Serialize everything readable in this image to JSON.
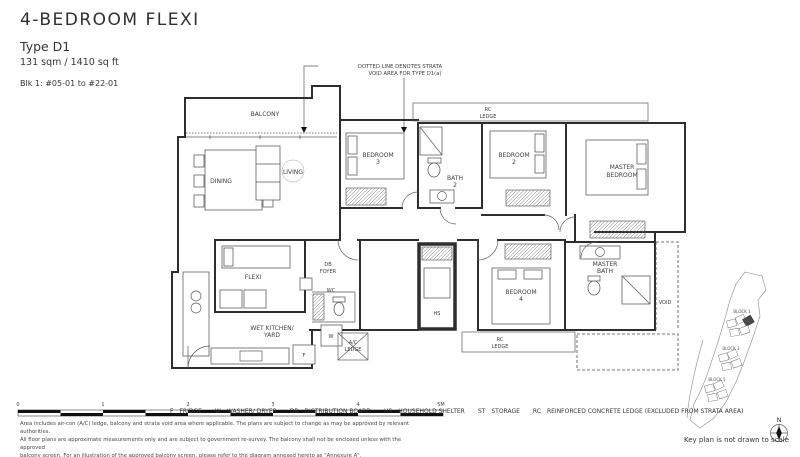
{
  "header": {
    "title": "4-BEDROOM FLEXI",
    "type": "Type D1",
    "area": "131 sqm / 1410 sq ft",
    "block_info": "Blk 1: #05-01 to #22-01"
  },
  "annotation": {
    "line1": "DOTTED LINE DENOTES STRATA",
    "line2": "VOID AREA FOR TYPE D1(a)"
  },
  "rooms": {
    "balcony": "BALCONY",
    "dining": "DINING",
    "living": "LIVING",
    "bedroom3_l1": "BEDROOM",
    "bedroom3_l2": "3",
    "bath2_l1": "BATH",
    "bath2_l2": "2",
    "bedroom2_l1": "BEDROOM",
    "bedroom2_l2": "2",
    "master_l1": "MASTER",
    "master_l2": "BEDROOM",
    "rc_ledge_top_l1": "RC",
    "rc_ledge_top_l2": "LEDGE",
    "flexi": "FLEXI",
    "foyer_l1": "DB",
    "foyer_l2": "FOYER",
    "wc": "WC",
    "hs": "HS",
    "washer": "W",
    "fridge": "F",
    "wet_kitchen_l1": "WET KITCHEN/",
    "wet_kitchen_l2": "YARD",
    "ac_ledge_l1": "A/C",
    "ac_ledge_l2": "LEDGE",
    "bedroom4_l1": "BEDROOM",
    "bedroom4_l2": "4",
    "rc_ledge_bottom_l1": "RC",
    "rc_ledge_bottom_l2": "LEDGE",
    "master_bath_l1": "MASTER",
    "master_bath_l2": "BATH",
    "void": "VOID"
  },
  "scale_bar": {
    "labels": [
      "0",
      "1",
      "2",
      "3",
      "4",
      "5M"
    ]
  },
  "legend": {
    "items": [
      {
        "abbr": "F",
        "label": "FRIDGE"
      },
      {
        "abbr": "W",
        "label": "WASHER/ DRYER"
      },
      {
        "abbr": "DB",
        "label": "DISTRIBUTION BOARD"
      },
      {
        "abbr": "HS",
        "label": "HOUSEHOLD SHELTER"
      },
      {
        "abbr": "ST",
        "label": "STORAGE"
      },
      {
        "abbr": "RC",
        "label": "REINFORCED CONCRETE LEDGE (EXCLUDED FROM STRATA AREA)"
      }
    ]
  },
  "disclaimer": {
    "line1": "Area includes air-con (A/C) ledge, balcony and strata void area where applicable. The plans are subject to change as may be approved by relevant authorities.",
    "line2": "All floor plans are approximate measurements only and are subject to government re-survey. The balcony shall not be enclosed unless with the approved",
    "line3": "balcony screen. For an illustration of the approved balcony screen, please refer to the diagram annexed hereto as \"Annexure A\"."
  },
  "key_plan": {
    "block1": "BLOCK 1",
    "block3": "BLOCK 3",
    "block5": "BLOCK 5",
    "note": "Key plan is not drawn to scale",
    "compass": "N"
  }
}
